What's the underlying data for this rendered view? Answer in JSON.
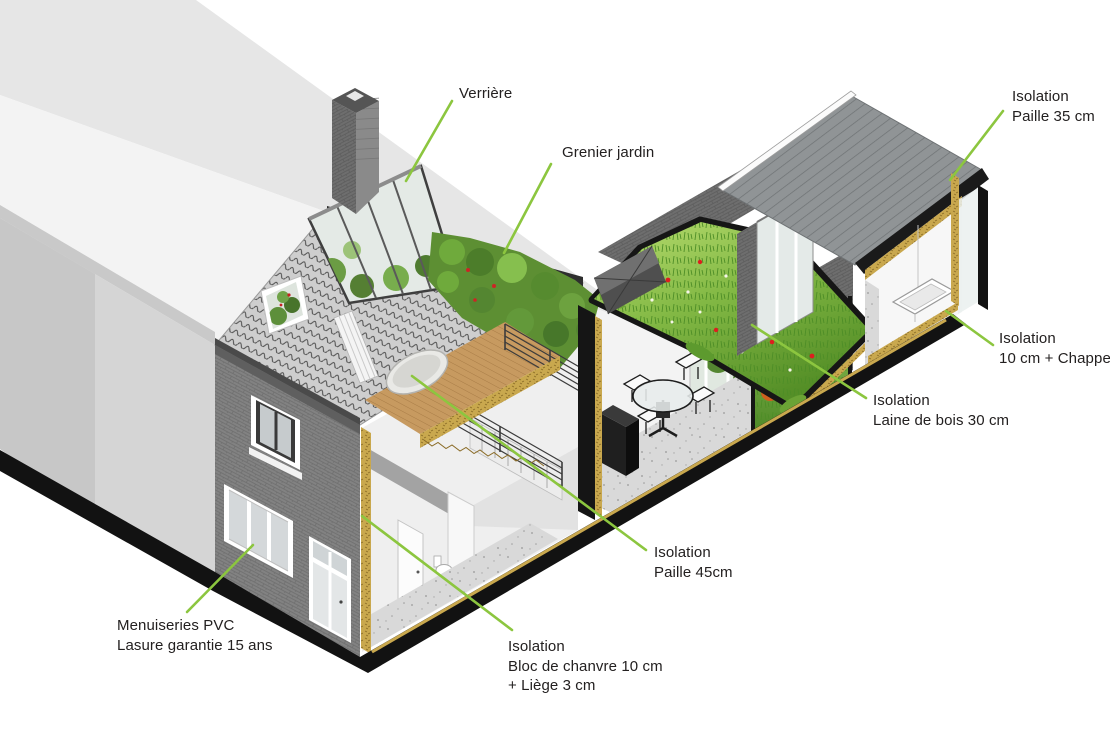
{
  "diagram": {
    "type": "architectural-axonometric-section",
    "language": "fr",
    "background": "#ffffff",
    "annotations": [
      {
        "id": "verriere",
        "lines": [
          "Verrière"
        ]
      },
      {
        "id": "grenier-jardin",
        "lines": [
          "Grenier jardin"
        ]
      },
      {
        "id": "isolation-paille-35",
        "lines": [
          "Isolation",
          "Paille 35 cm"
        ]
      },
      {
        "id": "isolation-chappe",
        "lines": [
          "Isolation",
          "10 cm + Chappe"
        ]
      },
      {
        "id": "isolation-laine-de-bois",
        "lines": [
          "Isolation",
          "Laine de bois 30 cm"
        ]
      },
      {
        "id": "isolation-paille-45",
        "lines": [
          "Isolation",
          "Paille 45cm"
        ]
      },
      {
        "id": "isolation-chanvre-liege",
        "lines": [
          "Isolation",
          "Bloc de chanvre 10 cm",
          "+ Liège 3 cm"
        ]
      },
      {
        "id": "menuiseries-pvc",
        "lines": [
          "Menuiseries PVC",
          "Lasure garantie 15 ans"
        ]
      }
    ],
    "colors": {
      "leader_line": "#8cc63f",
      "insulation_straw": "#c9a84e",
      "section_cut_black": "#141414",
      "roof_tiles": "#cfcfcf",
      "brick_dark": "#7f7f7f",
      "green_roof": "#76ab3a",
      "wood_deck": "#c79a60",
      "label_text": "#232020"
    }
  }
}
